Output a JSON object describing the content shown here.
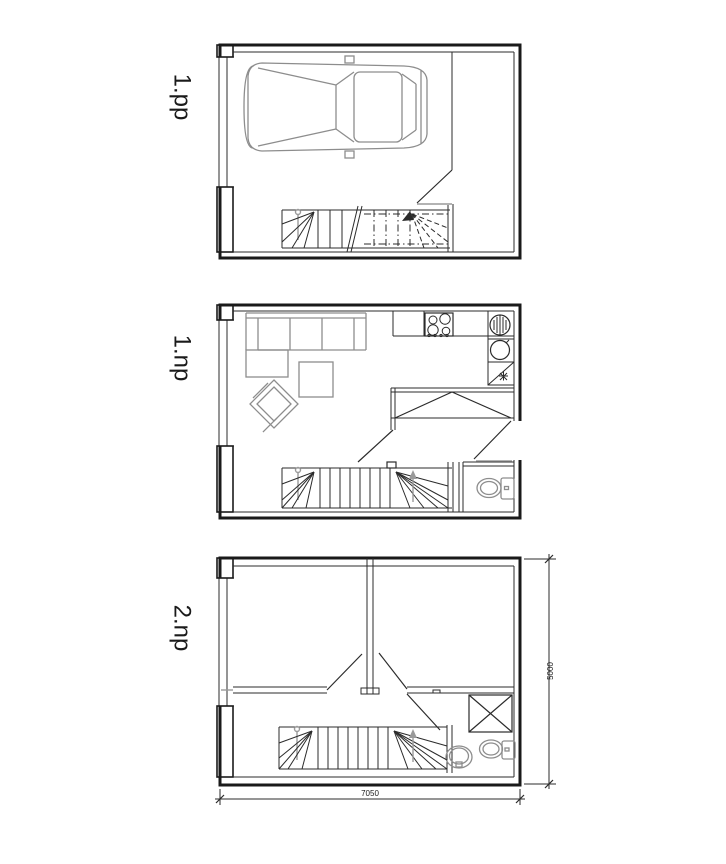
{
  "sheet": {
    "background": "#ffffff",
    "floor_labels": [
      {
        "id": "1pp",
        "text": "1.pp"
      },
      {
        "id": "1np",
        "text": "1.np"
      },
      {
        "id": "2np",
        "text": "2.np"
      }
    ],
    "dimensions": {
      "overall_width": "7050",
      "overall_height": "5000"
    },
    "colors": {
      "wall_line": "#1a1a1a",
      "furniture_line": "#8d8d8d",
      "threshold_line": "#b3b3b3"
    }
  }
}
